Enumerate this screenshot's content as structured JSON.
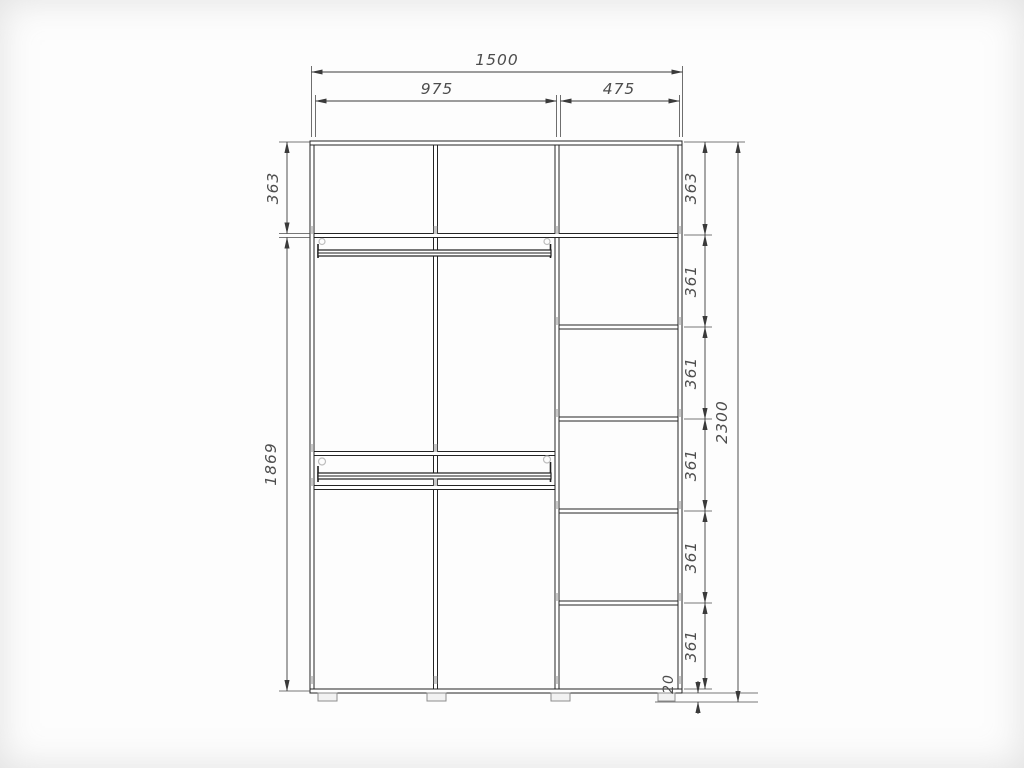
{
  "drawing": {
    "dims": {
      "total_width": "1500",
      "left_width": "975",
      "right_width": "475",
      "left_top": "363",
      "left_bottom": "1869",
      "right": [
        "363",
        "361",
        "361",
        "361",
        "361",
        "361"
      ],
      "total_height": "2300",
      "floor_gap": "20"
    }
  }
}
